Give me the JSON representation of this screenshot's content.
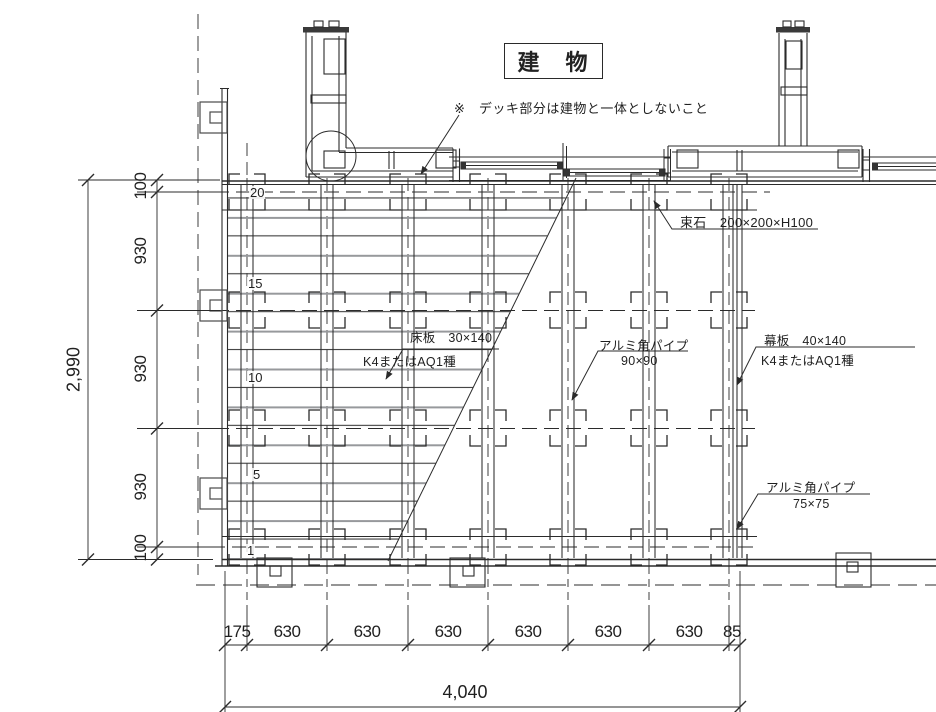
{
  "drawing": {
    "title": "建　物",
    "note": "※　デッキ部分は建物と一体としないこと",
    "callouts": {
      "foundation_stone": "束石　200×200×H100",
      "floor_board_line1": "床板　30×140",
      "floor_board_line2": "K4またはAQ1種",
      "alum_pipe90_line1": "アルミ角パイプ",
      "alum_pipe90_line2": "90×90",
      "fascia_line1": "幕板　40×140",
      "fascia_line2": "K4またはAQ1種",
      "alum_pipe75_line1": "アルミ角パイプ",
      "alum_pipe75_line2": "75×75"
    },
    "board_numbers": [
      "20",
      "15",
      "10",
      "5",
      "1"
    ],
    "dim_left": {
      "segments": [
        "100",
        "930",
        "930",
        "930",
        "100"
      ],
      "total": "2,990"
    },
    "dim_bottom": {
      "segments": [
        "175",
        "630",
        "630",
        "630",
        "630",
        "630",
        "630",
        "85"
      ],
      "total": "4,040"
    },
    "colors": {
      "line": "#2b2b2b",
      "board_edge_gray": "#97999c"
    }
  }
}
